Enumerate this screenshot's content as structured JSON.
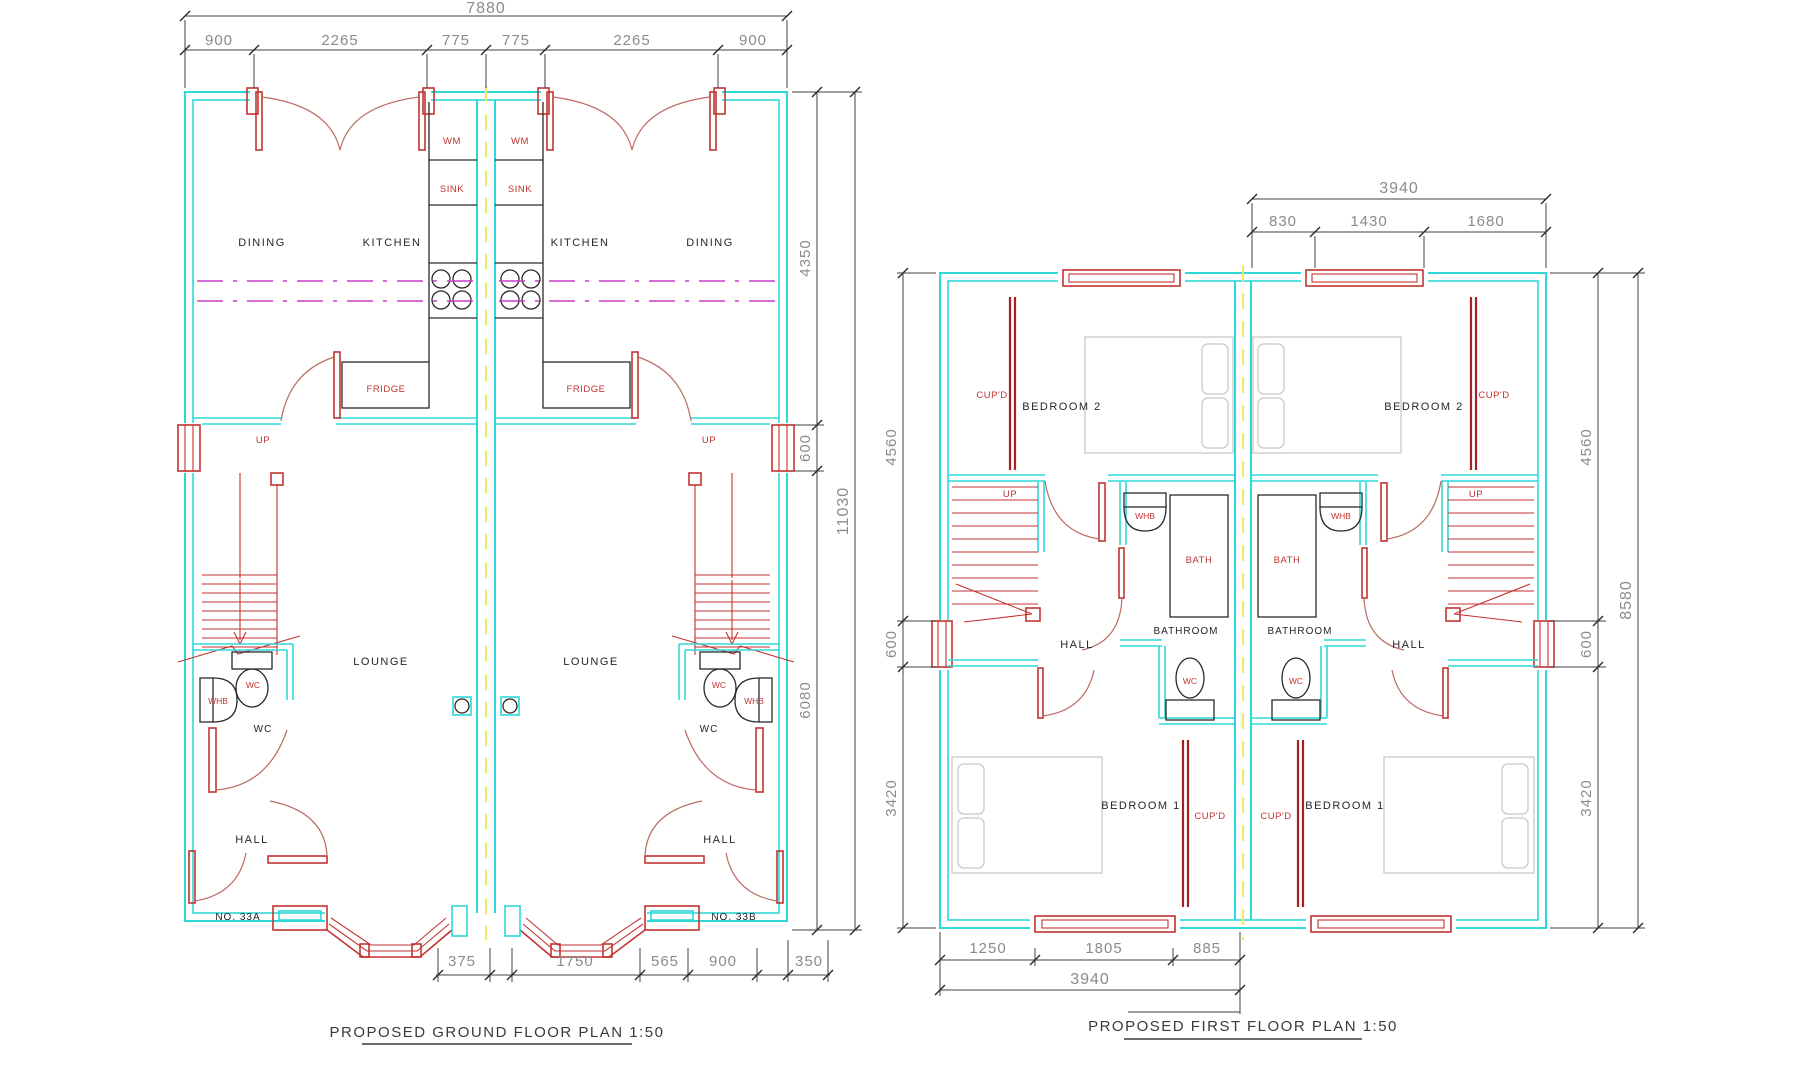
{
  "meta": {
    "drawing_type": "architectural floor plans",
    "colors": {
      "wall_cyan": "#2fd8d8",
      "red": "#c23330",
      "dark_red": "#a62121",
      "door_arc": "#bd6a63",
      "magenta": "#c83cc8",
      "party_wall_yellow": "#ecec6a",
      "dim_text_gray": "#8b8b8b",
      "black": "#262626",
      "bed_gray": "#c8c8c8",
      "background": "#ffffff"
    }
  },
  "ground": {
    "title": "PROPOSED GROUND FLOOR PLAN 1:50",
    "dim_total_top": "7880",
    "dims_top": [
      "900",
      "2265",
      "775",
      "775",
      "2265",
      "900"
    ],
    "dims_right": [
      "4350",
      "600",
      "6080"
    ],
    "dim_total_right": "11030",
    "dims_bottom": [
      "375",
      "1750",
      "565",
      "900",
      "350"
    ],
    "labels": {
      "dining": "DINING",
      "kitchen": "KITCHEN",
      "lounge": "LOUNGE",
      "hall": "HALL",
      "wc_room": "WC",
      "wm": "WM",
      "sink": "SINK",
      "fridge": "FRIDGE",
      "wc": "WC",
      "whb": "WHB",
      "up": "UP",
      "no_a": "NO. 33A",
      "no_b": "NO. 33B"
    }
  },
  "first": {
    "title": "PROPOSED FIRST FLOOR PLAN 1:50",
    "dim_total_top": "3940",
    "dims_top": [
      "830",
      "1430",
      "1680"
    ],
    "dims_left": [
      "4560",
      "600",
      "3420"
    ],
    "dims_right": [
      "4560",
      "600",
      "3420"
    ],
    "dim_total_right": "8580",
    "dims_bottom": [
      "1250",
      "1805",
      "885"
    ],
    "dim_total_bottom": "3940",
    "labels": {
      "bedroom1": "BEDROOM 1",
      "bedroom2": "BEDROOM 2",
      "bathroom": "BATHROOM",
      "hall": "HALL",
      "bath": "BATH",
      "whb": "WHB",
      "wc": "WC",
      "cupd": "CUP'D",
      "up": "UP"
    }
  }
}
